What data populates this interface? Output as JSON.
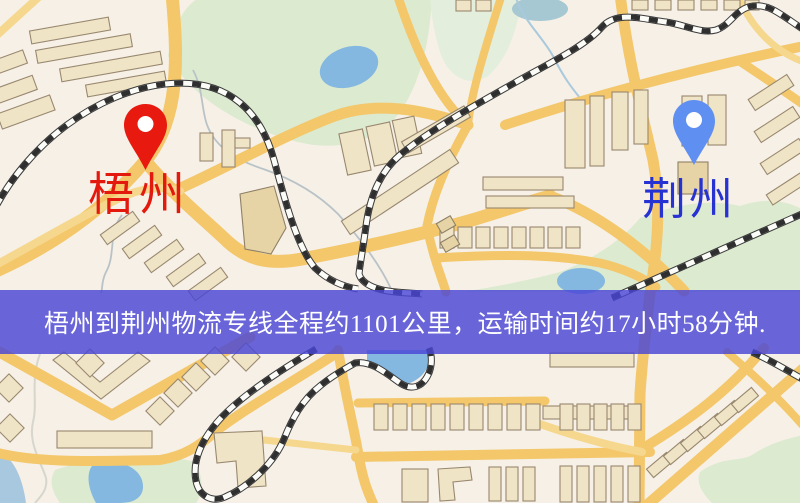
{
  "banner": {
    "text": "梧州到荆州物流专线全程约1101公里，运输时间约17小时58分钟.",
    "background": "rgba(73,70,213,0.82)",
    "text_color": "#ffffff"
  },
  "markers": [
    {
      "id": "wuzhou",
      "label": "梧州",
      "pin_color": "#e8190e",
      "label_color": "#e3190e"
    },
    {
      "id": "jingzhou",
      "label": "荆州",
      "pin_color": "#608ff2",
      "label_color": "#2633d2"
    }
  ],
  "map": {
    "colors": {
      "base": "#f6f0e7",
      "road": "#f3c76a",
      "road_minor": "#f6d78e",
      "building": "#efe4c6",
      "building_dark": "#e6d4a6",
      "green": "#dcead0",
      "water": "#84b8e0",
      "railway": "#2f2f2f"
    }
  }
}
